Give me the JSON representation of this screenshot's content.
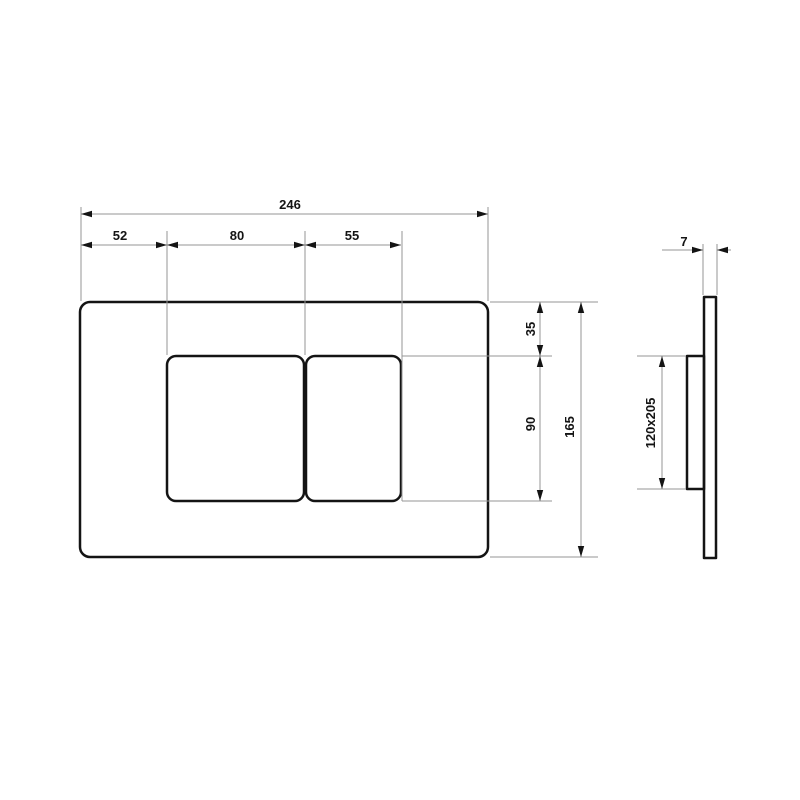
{
  "drawing": {
    "type": "technical-dimension-drawing",
    "subject": "wall flush plate - front and side view",
    "front_view": {
      "width_total": "246",
      "width_left": "52",
      "width_button_large": "80",
      "width_button_small": "55",
      "height_top": "35",
      "height_buttons": "90",
      "height_total": "165"
    },
    "side_view": {
      "thickness": "7",
      "frame_size": "120x205"
    },
    "colors": {
      "outline": "#141414",
      "dimension_line": "#969696",
      "text": "#141414",
      "background": "#ffffff"
    }
  }
}
